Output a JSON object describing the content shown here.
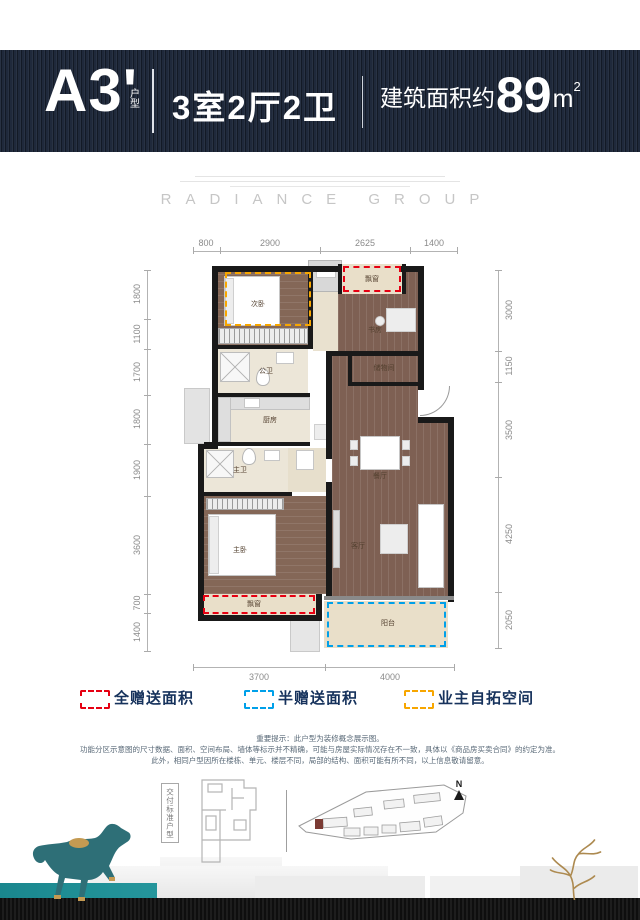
{
  "header": {
    "unit_code": "A3'",
    "unit_type_label": "户型",
    "rooms_summary": "3室2厅2卫",
    "area_prefix": "建筑面积约",
    "area_value": "89",
    "area_unit": "m",
    "area_exponent": "2"
  },
  "brand": {
    "name": "RADIANCE GROUP"
  },
  "floor_plan": {
    "rooms": [
      "次卧",
      "飘窗",
      "书房",
      "公卫",
      "储物间",
      "厨房",
      "主卫",
      "餐厅",
      "主卧",
      "客厅",
      "飘窗",
      "阳台"
    ],
    "dimensions": {
      "top": [
        "800",
        "2900",
        "2625",
        "1400"
      ],
      "left": [
        "1800",
        "1100",
        "1700",
        "1800",
        "1900",
        "3600",
        "700",
        "1400"
      ],
      "right": [
        "3000",
        "1150",
        "3500",
        "4250",
        "2050"
      ],
      "bottom": [
        "3700",
        "4000"
      ]
    }
  },
  "legend": {
    "items": [
      {
        "label": "全赠送面积",
        "color": "#e60012"
      },
      {
        "label": "半赠送面积",
        "color": "#00a0e9"
      },
      {
        "label": "业主自拓空间",
        "color": "#f7a600"
      }
    ]
  },
  "disclaimer": {
    "lines": [
      "重要提示：此户型为装修概念展示图。",
      "功能分区示意图的尺寸数据、面积、空间布局、墙体等标示并不精确，可能与房屋实际情况存在不一致，具体以《商品房买卖合同》的约定为准。",
      "此外，相同户型因所在楼栋、单元、楼层不同，局部的结构、面积可能有所不同，以上信息敬请留意。"
    ]
  },
  "footer": {
    "standard_unit_label": "交付标准户型",
    "north_label": "N"
  },
  "colors": {
    "header_navy": "#1b2537",
    "accent_teal": "#1e8e95",
    "wood_floor": "#7e6053",
    "full_gift_red": "#e60012",
    "half_gift_blue": "#00a0e9",
    "owner_expand_orange": "#f7a600"
  }
}
